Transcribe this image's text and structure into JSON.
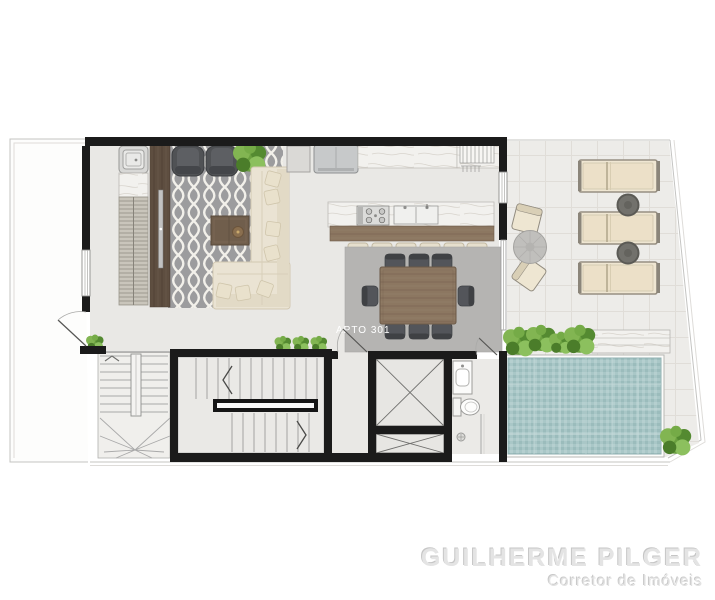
{
  "unit_label": "APTO 301",
  "watermark": {
    "line1": "GUILHERME PILGER",
    "line2": "Corretor de Imóveis"
  },
  "colors": {
    "wall": "#1b1b1b",
    "floor": "#e9e8e5",
    "terrace_floor": "#edece9",
    "living_rug": "#9c9c9e",
    "rug_pattern_white": "#f2f0ea",
    "dining_rug": "#b5b4b2",
    "pool_water": "#a9c7c7",
    "plant_green": "#6aa03f",
    "wood_dark": "#5e4e40",
    "wood_mid": "#8c7761",
    "sofa_cream": "#eae3d3",
    "chair_dark": "#505255",
    "marble": "#f2f1ee",
    "watermark_gray": "#e4e4e4"
  }
}
